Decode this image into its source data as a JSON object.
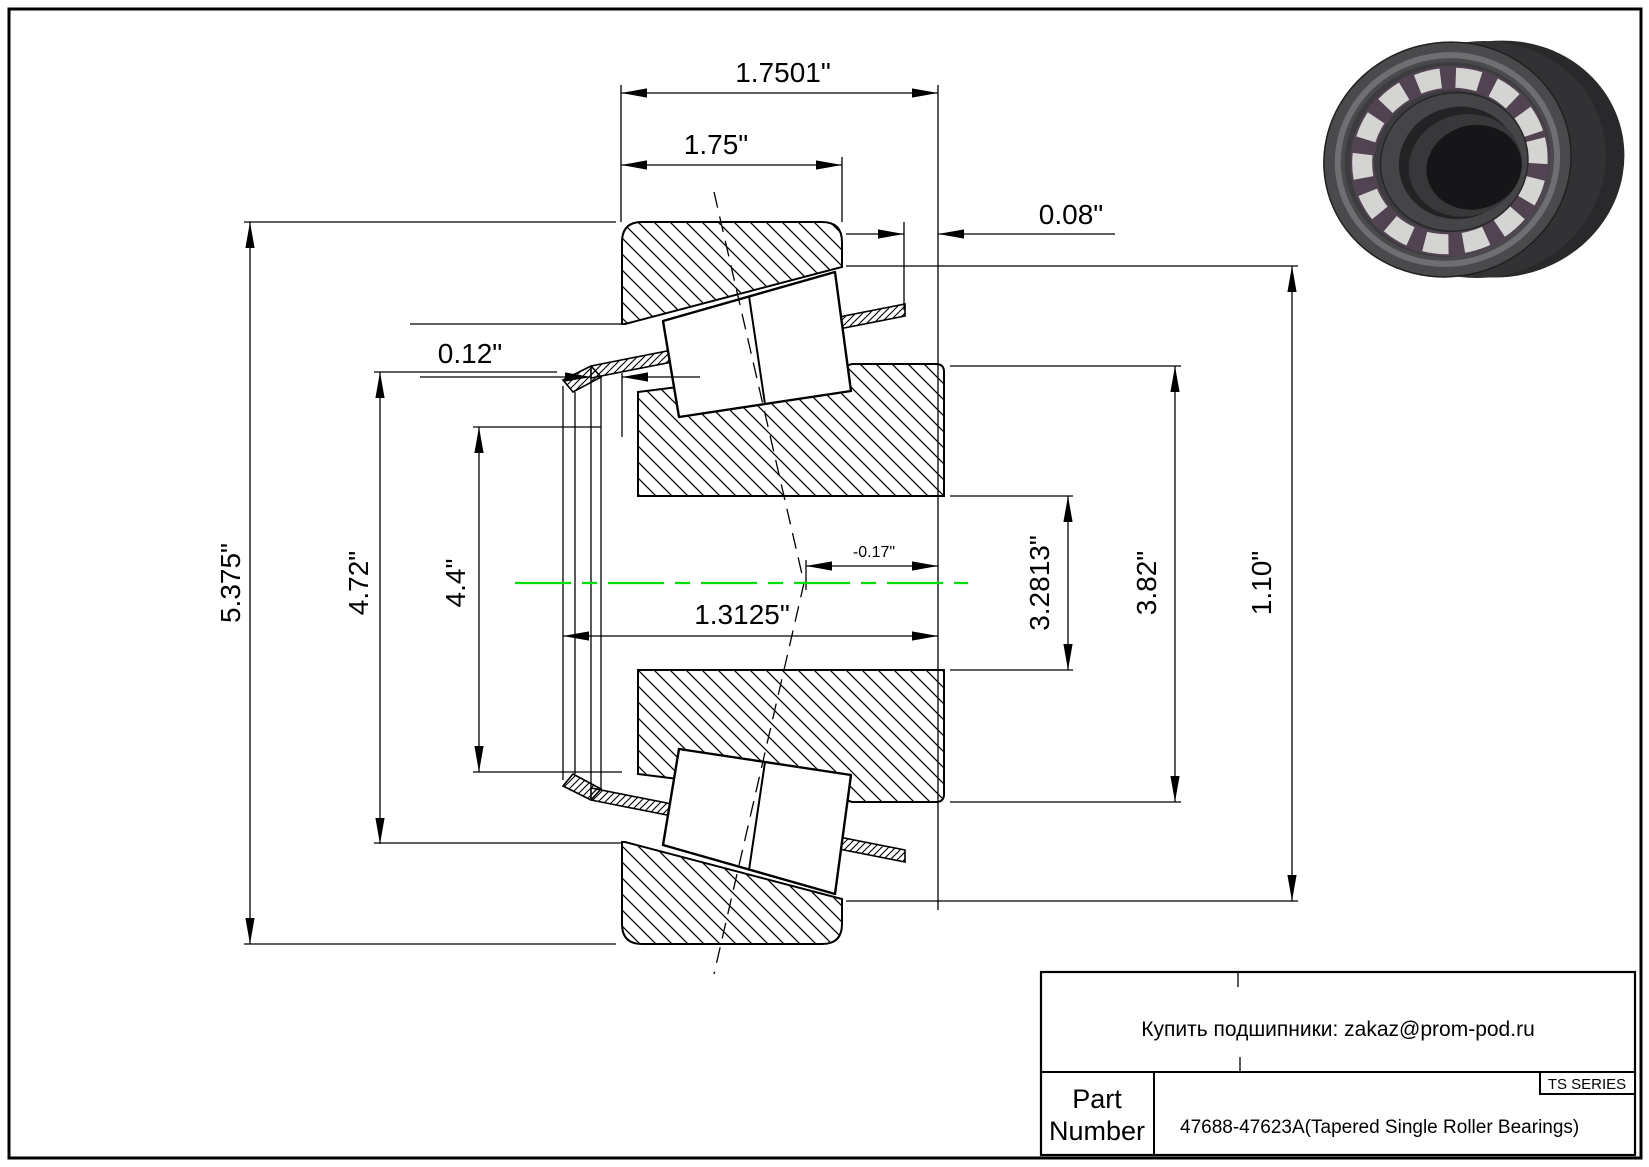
{
  "drawing": {
    "centerline_color": "#00dd00",
    "dims": {
      "overall_width": "1.7501\"",
      "cup_width": "1.75\"",
      "standout": "0.08\"",
      "front_offset": "0.12\"",
      "housing_od": "5.375\"",
      "flange_od": "4.72\"",
      "pilot_od": "4.4\"",
      "cone_width": "1.3125\"",
      "effective_center": "-0.17\"",
      "bore": "3.2813\"",
      "rib_od": "3.82\"",
      "cup_length": "1.10\""
    }
  },
  "illustration": {
    "name": "tapered-roller-bearing-3d-render"
  },
  "title_block": {
    "contact_line": "Купить подшипники: zakaz@prom-pod.ru",
    "series_badge": "TS SERIES",
    "part_label_line1": "Part",
    "part_label_line2": "Number",
    "part_number": "47688-47623A(Tapered Single Roller Bearings)"
  }
}
